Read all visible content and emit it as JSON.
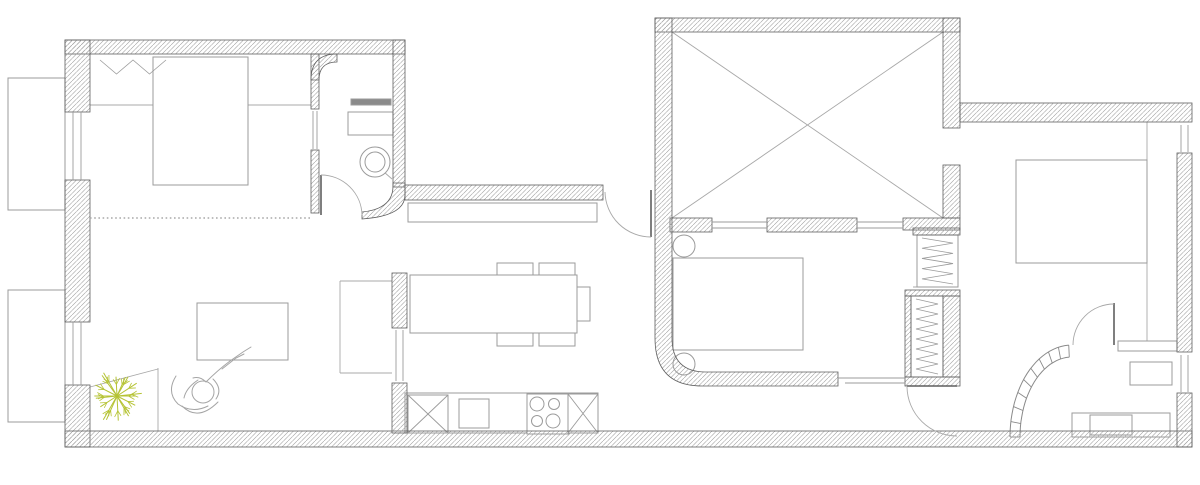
{
  "canvas": {
    "width": 1200,
    "height": 485
  },
  "colors": {
    "background": "#ffffff",
    "wall_stroke": "#5f5f5f",
    "hatch": "#9c9c9c",
    "furniture_stroke": "#9b9b9b",
    "light_line": "#a8a8a8",
    "dark_fill": "#8a8a8a",
    "plant": "#b5c334",
    "person": "#a5a5a5"
  },
  "wall_rects": [
    {
      "name": "wall-top-left-block",
      "x": 65,
      "y": 40,
      "w": 340,
      "h": 14
    },
    {
      "name": "wall-left-upper",
      "x": 65,
      "y": 40,
      "w": 25,
      "h": 72
    },
    {
      "name": "wall-left-middle",
      "x": 65,
      "y": 180,
      "w": 25,
      "h": 142
    },
    {
      "name": "wall-left-lower",
      "x": 65,
      "y": 385,
      "w": 25,
      "h": 62
    },
    {
      "name": "wall-bottom",
      "x": 65,
      "y": 431,
      "w": 1127,
      "h": 16
    },
    {
      "name": "wall-bathroom1-right",
      "x": 393,
      "y": 40,
      "w": 12,
      "h": 147
    },
    {
      "name": "wall-bathroom1-divider-upper",
      "x": 311,
      "y": 54,
      "w": 8,
      "h": 55
    },
    {
      "name": "wall-bathroom1-divider-lower",
      "x": 311,
      "y": 150,
      "w": 8,
      "h": 63
    },
    {
      "name": "wall-kitchen-top",
      "x": 405,
      "y": 185,
      "w": 198,
      "h": 15
    },
    {
      "name": "wall-kitchen-divider-upper",
      "x": 392,
      "y": 273,
      "w": 15,
      "h": 55
    },
    {
      "name": "wall-kitchen-divider-lower",
      "x": 392,
      "y": 383,
      "w": 15,
      "h": 50
    },
    {
      "name": "wall-patio-top",
      "x": 655,
      "y": 18,
      "w": 305,
      "h": 14
    },
    {
      "name": "wall-patio-right-upper",
      "x": 943,
      "y": 18,
      "w": 17,
      "h": 110
    },
    {
      "name": "wall-patio-right-lower",
      "x": 943,
      "y": 165,
      "w": 17,
      "h": 53
    },
    {
      "name": "wall-patio-bottom-a",
      "x": 670,
      "y": 218,
      "w": 42,
      "h": 14
    },
    {
      "name": "wall-patio-bottom-b",
      "x": 767,
      "y": 218,
      "w": 90,
      "h": 14
    },
    {
      "name": "wall-patio-bottom-c",
      "x": 903,
      "y": 218,
      "w": 57,
      "h": 12
    },
    {
      "name": "wall-bedroom3-top",
      "x": 960,
      "y": 103,
      "w": 232,
      "h": 19
    },
    {
      "name": "wall-right-upper",
      "x": 1177,
      "y": 153,
      "w": 15,
      "h": 199
    },
    {
      "name": "wall-right-lower",
      "x": 1177,
      "y": 393,
      "w": 15,
      "h": 54
    },
    {
      "name": "wall-closet1-top",
      "x": 913,
      "y": 228,
      "w": 47,
      "h": 7
    },
    {
      "name": "wall-closet2-top",
      "x": 905,
      "y": 290,
      "w": 55,
      "h": 6
    },
    {
      "name": "wall-closet2-left",
      "x": 905,
      "y": 296,
      "w": 6,
      "h": 81
    },
    {
      "name": "wall-closet2-right",
      "x": 943,
      "y": 296,
      "w": 17,
      "h": 81
    },
    {
      "name": "wall-closet2-bottom",
      "x": 905,
      "y": 377,
      "w": 55,
      "h": 9
    }
  ],
  "wall_paths": [
    {
      "name": "wall-patio-left-rounded",
      "d": "M655,18 L672,18 L672,338 Q672,372 706,372 L838,372 L838,386 L702,386 Q655,386 655,338 Z"
    },
    {
      "name": "wall-bathroom1-curved-end",
      "d": "M393,183 L405,183 L405,195 Q405,216 362,219 L362,212 Q393,209 393,186 Z"
    },
    {
      "name": "wall-bathroom1-rounded-corner",
      "d": "M311,80 Q311,54 337,54 L337,62 Q319,62 319,80 Z"
    }
  ],
  "floor_lines": [
    {
      "name": "headboard-shelf-left",
      "x1": 90,
      "y1": 105,
      "x2": 153,
      "y2": 105
    },
    {
      "name": "headboard-shelf-right",
      "x1": 248,
      "y1": 105,
      "x2": 311,
      "y2": 105
    },
    {
      "name": "radiator-divider",
      "x1": 170,
      "y1": 57,
      "x2": 170,
      "y2": 105
    },
    {
      "name": "kitchen-floor-top",
      "x1": 340,
      "y1": 281,
      "x2": 392,
      "y2": 281
    },
    {
      "name": "kitchen-floor-left",
      "x1": 340,
      "y1": 281,
      "x2": 340,
      "y2": 373
    },
    {
      "name": "kitchen-floor-bottom",
      "x1": 340,
      "y1": 373,
      "x2": 392,
      "y2": 373
    },
    {
      "name": "planter-edge-vertical",
      "x1": 158,
      "y1": 368,
      "x2": 158,
      "y2": 431
    },
    {
      "name": "planter-edge-diagonal",
      "x1": 90,
      "y1": 387,
      "x2": 158,
      "y2": 369
    },
    {
      "name": "bedroom3-floor-line",
      "x1": 1147,
      "y1": 122,
      "x2": 1147,
      "y2": 341
    },
    {
      "name": "bed1-fold-line",
      "x1": 153,
      "y1": 170,
      "x2": 248,
      "y2": 170
    },
    {
      "name": "closet1-bottom-line",
      "x1": 913,
      "y1": 287,
      "x2": 958,
      "y2": 287
    },
    {
      "name": "vanity1-divider",
      "x1": 378,
      "y1": 112,
      "x2": 378,
      "y2": 135
    },
    {
      "name": "vanity2-divider",
      "x1": 1162,
      "y1": 362,
      "x2": 1162,
      "y2": 385
    },
    {
      "name": "cabinet-row-divider-1",
      "x1": 1133,
      "y1": 341,
      "x2": 1133,
      "y2": 351
    },
    {
      "name": "cabinet-row-divider-2",
      "x1": 1148,
      "y1": 341,
      "x2": 1148,
      "y2": 351
    },
    {
      "name": "cabinet-row-divider-3",
      "x1": 1163,
      "y1": 341,
      "x2": 1163,
      "y2": 351
    },
    {
      "name": "toilet-handle",
      "x1": 384,
      "y1": 172,
      "x2": 392,
      "y2": 179
    },
    {
      "name": "faucet-line-a",
      "x1": 1078,
      "y1": 425,
      "x2": 1090,
      "y2": 425
    },
    {
      "name": "faucet-line-b",
      "x1": 1084,
      "y1": 421,
      "x2": 1084,
      "y2": 429
    }
  ],
  "dotted_lines": [
    {
      "name": "bedroom1-partition-dotted",
      "x1": 90,
      "y1": 218,
      "x2": 311,
      "y2": 218
    }
  ],
  "windows": [
    {
      "name": "window-left-upper",
      "lines": [
        [
          73,
          112,
          73,
          180
        ],
        [
          81,
          112,
          81,
          180
        ]
      ]
    },
    {
      "name": "window-left-lower",
      "lines": [
        [
          73,
          322,
          73,
          385
        ],
        [
          81,
          322,
          81,
          385
        ]
      ]
    },
    {
      "name": "window-bathroom1-slider",
      "lines": [
        [
          313,
          111,
          313,
          149
        ],
        [
          317,
          111,
          317,
          149
        ]
      ]
    },
    {
      "name": "window-patio-a",
      "lines": [
        [
          712,
          222,
          767,
          222
        ],
        [
          712,
          228,
          767,
          228
        ]
      ]
    },
    {
      "name": "window-patio-b",
      "lines": [
        [
          857,
          222,
          903,
          222
        ],
        [
          857,
          228,
          903,
          228
        ]
      ]
    },
    {
      "name": "window-bedroom3",
      "lines": [
        [
          1181,
          125,
          1181,
          152
        ],
        [
          1188,
          125,
          1188,
          152
        ]
      ]
    },
    {
      "name": "window-bathroom2",
      "lines": [
        [
          1181,
          355,
          1181,
          392
        ],
        [
          1188,
          355,
          1188,
          392
        ]
      ]
    },
    {
      "name": "window-kitchen-hatch",
      "lines": [
        [
          396,
          330,
          396,
          381
        ],
        [
          403,
          330,
          403,
          381
        ]
      ]
    },
    {
      "name": "sliding-door-bedroom2",
      "lines": [
        [
          838,
          378,
          905,
          378
        ],
        [
          845,
          383,
          905,
          383
        ]
      ]
    }
  ],
  "doors": [
    {
      "name": "door-bathroom1",
      "leaf": [
        321,
        175,
        321,
        215
      ],
      "arc": "M321,175 A41,41 0 0 1 362,215"
    },
    {
      "name": "door-entry",
      "leaf": [
        651,
        190,
        651,
        237
      ],
      "arc": "M605,192 A46,46 0 0 0 651,237"
    },
    {
      "name": "door-hall",
      "leaf": [
        907,
        386,
        957,
        386
      ],
      "arc": "M907,387 A50,50 0 0 0 957,436"
    },
    {
      "name": "door-bathroom2",
      "leaf": [
        1114,
        303,
        1114,
        345
      ],
      "arc": "M1073,345 A41,41 0 0 1 1114,304"
    }
  ],
  "furniture": [
    {
      "name": "balcony-1",
      "x": 8,
      "y": 78,
      "w": 57,
      "h": 132,
      "fill": "none"
    },
    {
      "name": "balcony-2",
      "x": 8,
      "y": 290,
      "w": 57,
      "h": 132,
      "fill": "none"
    },
    {
      "name": "bed-1",
      "x": 153,
      "y": 57,
      "w": 95,
      "h": 128
    },
    {
      "name": "vanity-1",
      "x": 348,
      "y": 112,
      "w": 45,
      "h": 23
    },
    {
      "name": "shelf-niche",
      "x": 351,
      "y": 99,
      "w": 40,
      "h": 6,
      "fill": "#8a8a8a"
    },
    {
      "name": "tv-bench",
      "x": 197,
      "y": 303,
      "w": 91,
      "h": 57
    },
    {
      "name": "counter-shelf",
      "x": 408,
      "y": 203,
      "w": 189,
      "h": 19
    },
    {
      "name": "chair-1",
      "x": 497,
      "y": 263,
      "w": 36,
      "h": 13
    },
    {
      "name": "chair-2",
      "x": 539,
      "y": 263,
      "w": 36,
      "h": 13
    },
    {
      "name": "chair-3",
      "x": 497,
      "y": 333,
      "w": 36,
      "h": 13
    },
    {
      "name": "chair-4",
      "x": 539,
      "y": 333,
      "w": 36,
      "h": 13
    },
    {
      "name": "chair-5",
      "x": 577,
      "y": 287,
      "w": 13,
      "h": 34
    },
    {
      "name": "dining-table",
      "x": 410,
      "y": 275,
      "w": 167,
      "h": 58
    },
    {
      "name": "kitchen-counter",
      "x": 405,
      "y": 393,
      "w": 193,
      "h": 40
    },
    {
      "name": "kitchen-sink",
      "x": 459,
      "y": 399,
      "w": 30,
      "h": 29
    },
    {
      "name": "stove",
      "x": 527,
      "y": 394,
      "w": 42,
      "h": 40
    },
    {
      "name": "bed-2",
      "x": 673,
      "y": 258,
      "w": 130,
      "h": 92
    },
    {
      "name": "closet-1",
      "x": 917,
      "y": 235,
      "w": 41,
      "h": 52
    },
    {
      "name": "closet-2",
      "x": 911,
      "y": 296,
      "w": 32,
      "h": 81
    },
    {
      "name": "bed-3",
      "x": 1016,
      "y": 160,
      "w": 131,
      "h": 103
    },
    {
      "name": "vanity-2",
      "x": 1130,
      "y": 362,
      "w": 42,
      "h": 23
    },
    {
      "name": "cabinet-row",
      "x": 1118,
      "y": 341,
      "w": 59,
      "h": 10
    },
    {
      "name": "shower-tray",
      "x": 1072,
      "y": 413,
      "w": 98,
      "h": 24
    },
    {
      "name": "washer",
      "x": 1090,
      "y": 415,
      "w": 42,
      "h": 20
    }
  ],
  "circles": [
    {
      "name": "toilet-outer",
      "cx": 375,
      "cy": 162,
      "r": 15
    },
    {
      "name": "toilet-inner",
      "cx": 375,
      "cy": 162,
      "r": 10
    },
    {
      "name": "nightstand-1",
      "cx": 684,
      "cy": 246,
      "r": 11
    },
    {
      "name": "nightstand-2",
      "cx": 684,
      "cy": 364,
      "r": 11
    },
    {
      "name": "burner-1",
      "cx": 537,
      "cy": 404,
      "r": 7
    },
    {
      "name": "burner-2",
      "cx": 554,
      "cy": 404,
      "r": 5.5
    },
    {
      "name": "burner-3",
      "cx": 537,
      "cy": 421,
      "r": 5.5
    },
    {
      "name": "burner-4",
      "cx": 553,
      "cy": 421,
      "r": 7
    }
  ],
  "cross_boxes": [
    {
      "name": "cabinet-cross-1",
      "x": 408,
      "y": 395,
      "w": 40,
      "h": 38
    },
    {
      "name": "cabinet-cross-2",
      "x": 568,
      "y": 394,
      "w": 30,
      "h": 39
    }
  ],
  "zigzags": [
    {
      "name": "closet1-rail",
      "x": 920,
      "y": 238,
      "w": 35,
      "h": 46,
      "segments": 9,
      "dir": "v"
    },
    {
      "name": "closet2-rail",
      "x": 914,
      "y": 299,
      "w": 26,
      "h": 75,
      "segments": 15,
      "dir": "v"
    },
    {
      "name": "radiator-coil",
      "x": 100,
      "y": 58,
      "w": 66,
      "h": 18,
      "segments": 4,
      "dir": "h"
    }
  ],
  "patio_cross": {
    "name": "patio-x-mark",
    "diagonals": [
      [
        672,
        32,
        943,
        218
      ],
      [
        943,
        32,
        672,
        218
      ]
    ]
  },
  "glass_block_wall": {
    "name": "glass-block-wall",
    "cx": 1072,
    "cy": 437,
    "rx_outer": 62,
    "ry_outer": 92,
    "rx_inner": 52,
    "ry_inner": 80,
    "deg_start": 180,
    "deg_end": 267,
    "ticks": 9
  },
  "plant": {
    "name": "plant",
    "cx": 117,
    "cy": 396,
    "r": 28,
    "branches": 18
  },
  "person": {
    "name": "person-on-lounger",
    "head": {
      "cx": 203,
      "cy": 392,
      "r": 11
    },
    "paths": [
      "M176,376 Q166,392 178,404 Q192,414 208,406",
      "M182,406 Q198,422 218,402",
      "M206,382 Q218,370 230,361",
      "M230,361 L243,352 L251,347",
      "M222,369 L236,358 L244,354",
      "M198,380 Q186,388 184,398",
      "M213,379 Q223,389 216,399",
      "M206,382 Q200,376 193,378"
    ]
  }
}
